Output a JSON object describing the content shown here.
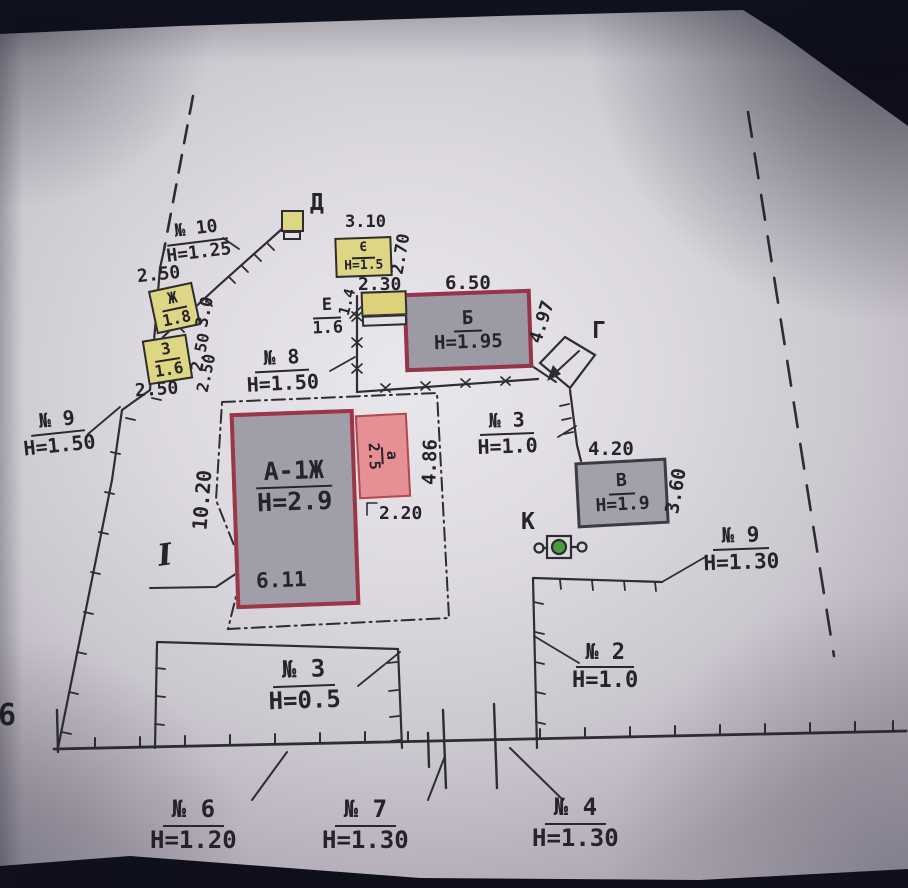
{
  "buildings": {
    "a1zh": {
      "label": "А-1Ж",
      "height": "Н=2.9"
    },
    "a_small": {
      "label": "а",
      "height": "2.5"
    },
    "b": {
      "label": "Б",
      "height": "Н=1.95"
    },
    "v": {
      "label": "В",
      "height": "Н=1.9"
    },
    "g": {
      "label": "Г"
    },
    "d": {
      "label": "Д"
    },
    "ie": {
      "label": "Є",
      "height": "Н=1.5"
    },
    "e": {
      "label": "Е",
      "height": "1.6"
    },
    "zh": {
      "label": "Ж",
      "height": "1.8"
    },
    "z": {
      "label": "З",
      "height": "1.6"
    },
    "k": {
      "label": "К"
    },
    "section_i": {
      "label": "I"
    }
  },
  "fence_labels": {
    "n10": {
      "no": "№ 10",
      "h": "Н=1.25"
    },
    "n9_left": {
      "no": "№ 9",
      "h": "Н=1.50"
    },
    "n8": {
      "no": "№ 8",
      "h": "Н=1.50"
    },
    "n3_mid": {
      "no": "№ 3",
      "h": "Н=1.0"
    },
    "n9_right": {
      "no": "№ 9",
      "h": "Н=1.30"
    },
    "n2": {
      "no": "№ 2",
      "h": "Н=1.0"
    },
    "n3_bottom": {
      "no": "№ 3",
      "h": "Н=0.5"
    },
    "n6": {
      "no": "№ 6",
      "h": "Н=1.20"
    },
    "n7": {
      "no": "№ 7",
      "h": "Н=1.30"
    },
    "n4": {
      "no": "№ 4",
      "h": "Н=1.30"
    }
  },
  "dims": {
    "ie_top": "3.10",
    "ie_right": "2.70",
    "annex_top": "2.30",
    "annex_left": "1.4",
    "b_top": "6.50",
    "b_right": "4.97",
    "zh_above": "2.50",
    "zh_right": "3.0",
    "z_right_1": "2.50",
    "z_right_2": "2.50",
    "z_below": "2.50",
    "a1_left": "10.20",
    "a1_bottom": "6.11",
    "a_right": "4.86",
    "a_below": "2.20",
    "v_top": "4.20",
    "v_right": "3.60"
  },
  "edge": {
    "partial_digit": "6"
  },
  "colors": {
    "paper": "#ddd9e0",
    "building_gray": "#9c9ba5",
    "building_yellow": "#ddd685",
    "building_pink": "#e59094",
    "border_red": "#97334a",
    "well_green": "#4a9b3d",
    "line": "#2e2d30"
  }
}
